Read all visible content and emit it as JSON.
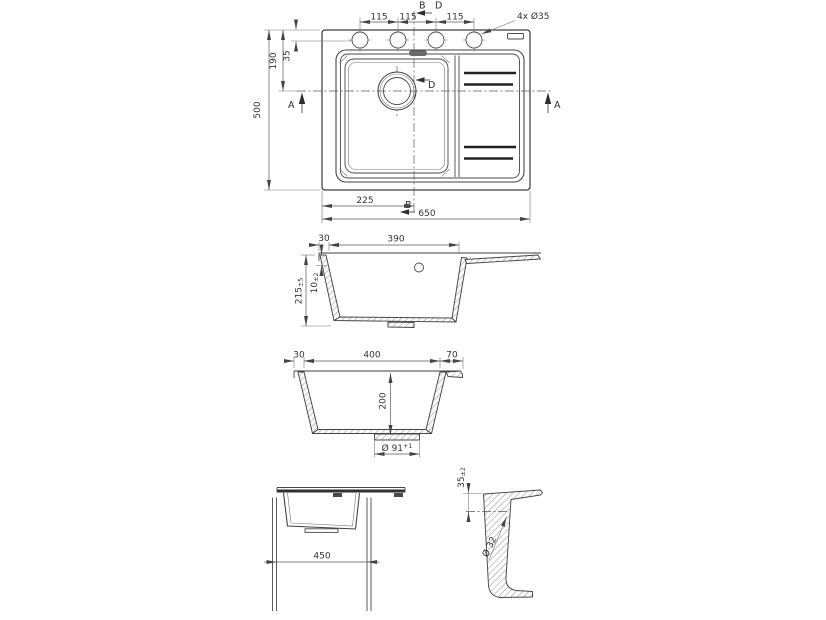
{
  "plan": {
    "dim_115_1": "115",
    "dim_115_2": "115",
    "dim_115_3": "115",
    "holes_note": "4x Ø35",
    "dim_35": "35",
    "dim_190": "190",
    "dim_500": "500",
    "dim_225": "225",
    "dim_650": "650",
    "sec_b_top": "B",
    "sec_d_top": "D",
    "sec_d_drain": "D",
    "sec_b_bottom": "B",
    "sec_a_left": "A",
    "sec_a_right": "A"
  },
  "section_long": {
    "dim_30": "30",
    "dim_390": "390",
    "dim_10": {
      "value": "10",
      "tol": "±2"
    },
    "dim_215": {
      "value": "215",
      "tol": "±5"
    }
  },
  "section_cross": {
    "dim_30": "30",
    "dim_400": "400",
    "dim_70": "70",
    "dim_200": "200",
    "dim_drain": {
      "value": "Ø 91",
      "tol": "+1"
    }
  },
  "front_view": {
    "dim_450": "450"
  },
  "detail_view": {
    "dim_35": {
      "value": "35",
      "tol": "±2"
    },
    "dim_hole": "Ø 32"
  }
}
